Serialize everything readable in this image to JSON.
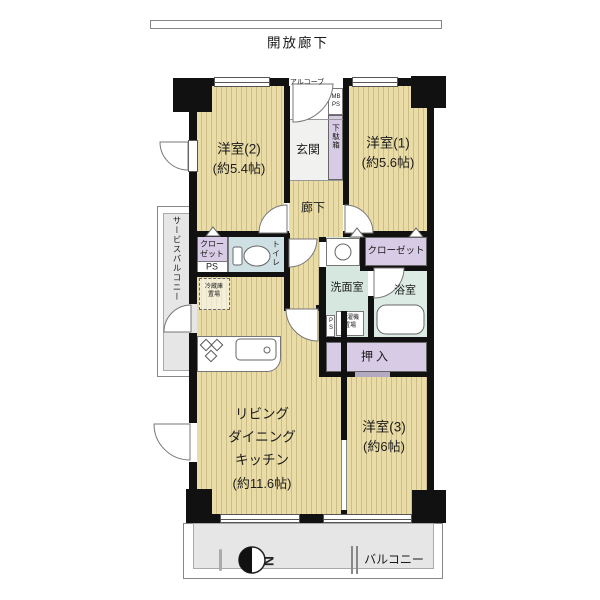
{
  "plan": {
    "corridor_label": "開放廊下",
    "alcove": "アルコーブ",
    "meter_box": "MB",
    "pipe_space_top": "PS",
    "entrance": "玄関",
    "shoe_box": "下駄箱",
    "western2": {
      "name": "洋室(2)",
      "area": "(約5.4帖)"
    },
    "western1": {
      "name": "洋室(1)",
      "area": "(約5.6帖)"
    },
    "western3": {
      "name": "洋室(3)",
      "area": "(約6帖)"
    },
    "ldk": {
      "line1": "リビング",
      "line2": "ダイニング",
      "line3": "キッチン",
      "line4": "(約11.6帖)"
    },
    "hallway": "廊下",
    "closet_left": {
      "line1": "クロー",
      "line2": "ゼット"
    },
    "pipe_space_left": "PS",
    "toilet": "トイレ",
    "refrigerator": {
      "line1": "冷蔵庫",
      "line2": "置場"
    },
    "washroom": "洗面室",
    "laundry": {
      "line1": "洗濯機",
      "line2": "置場"
    },
    "pipe_space_wash": "PS",
    "bath": "浴室",
    "closet_right": "クローゼット",
    "oshiire": "押入",
    "service_balcony": "サービスバルコニー",
    "balcony": "バルコニー",
    "compass": "N"
  },
  "colors": {
    "wall": "#111111",
    "wood_floor": "#e9dca7",
    "wood_stripe": "#cdbe87",
    "closet_lavender": "#d7cbe5",
    "wet_area_green": "#d6e7e0",
    "toilet_blue": "#cfe0e4",
    "balcony_gray": "#e6e6e6"
  }
}
